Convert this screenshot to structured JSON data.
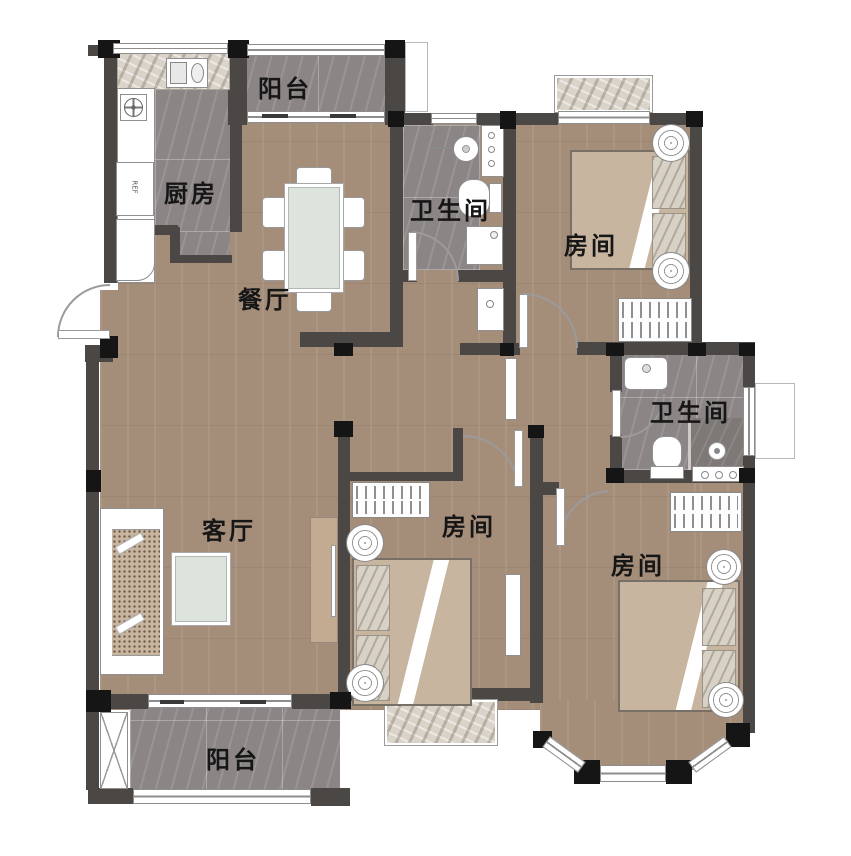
{
  "plan_title": "3-bedroom apartment floor plan",
  "rooms": {
    "balcony_top": {
      "label": "阳台"
    },
    "kitchen": {
      "label": "厨房"
    },
    "dining": {
      "label": "餐厅"
    },
    "bathroom_top": {
      "label": "卫生间"
    },
    "bedroom_top_right": {
      "label": "房间"
    },
    "bathroom_right": {
      "label": "卫生间"
    },
    "living": {
      "label": "客厅"
    },
    "bedroom_middle": {
      "label": "房间"
    },
    "bedroom_bottom_right": {
      "label": "房间"
    },
    "balcony_bottom": {
      "label": "阳台"
    }
  },
  "appliances": {
    "fridge_label": "REF"
  },
  "colors": {
    "wood_floor": "#a48d79",
    "gray_tile": "#8b8685",
    "wall": "#4a4745",
    "column": "#151515",
    "table_top": "#dde4de",
    "mattress": "#c7b5a0",
    "label_text": "#161616"
  }
}
